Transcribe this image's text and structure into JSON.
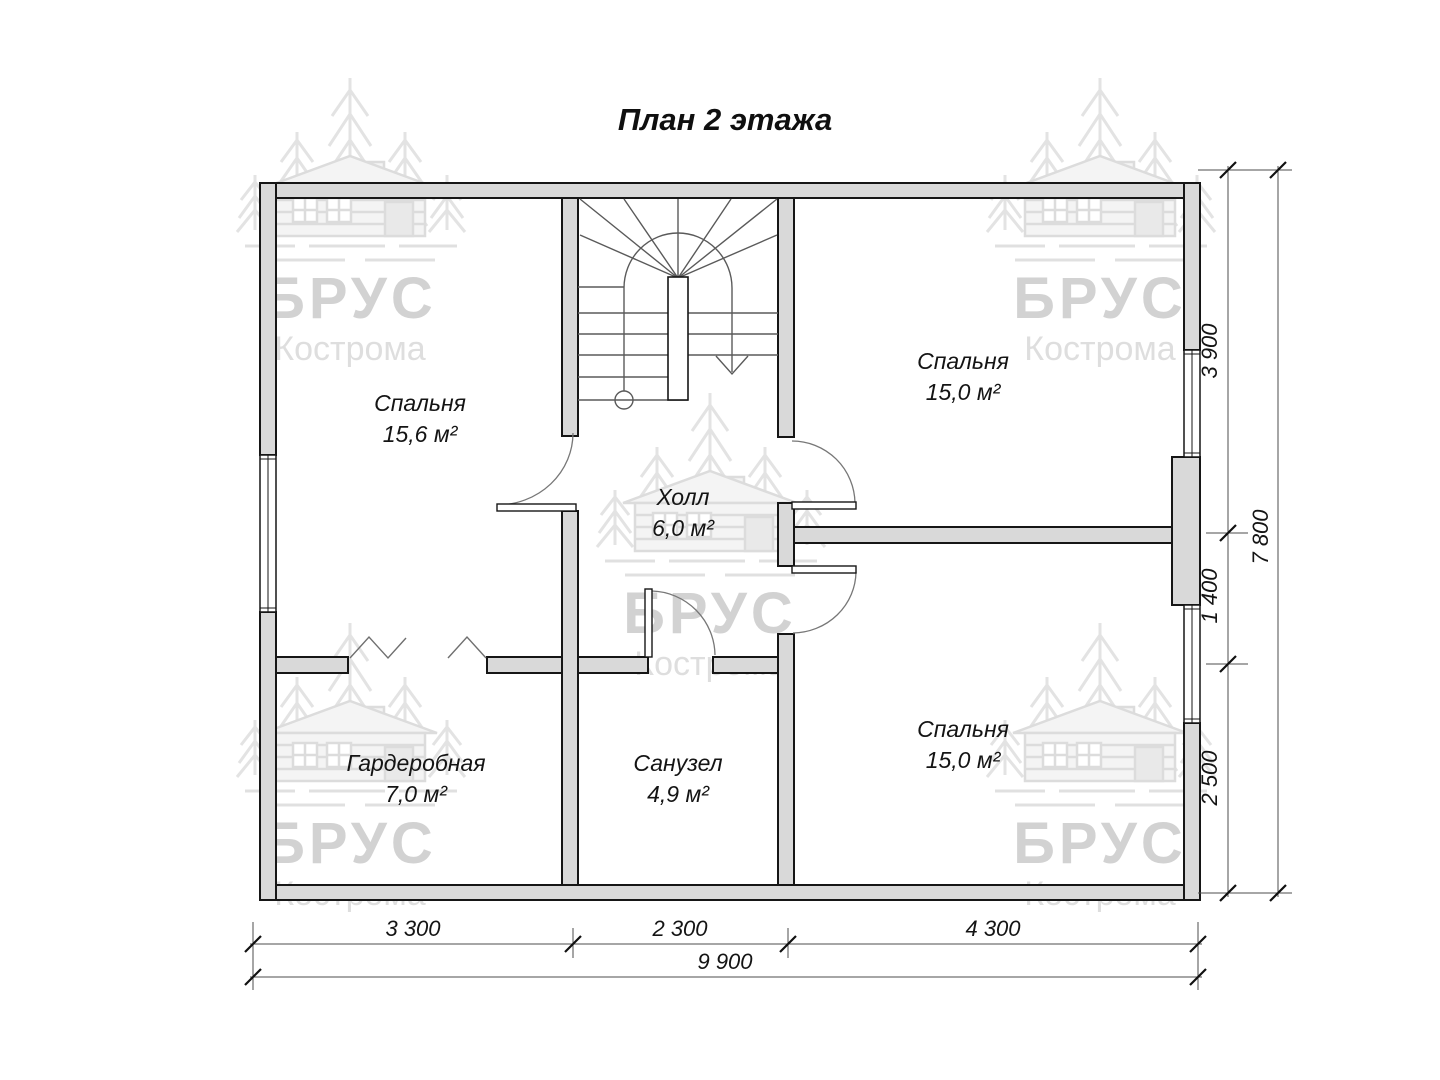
{
  "title": "План 2 этажа",
  "watermark": {
    "brand": "БРУС",
    "city": "Кострома"
  },
  "rooms": {
    "bedroom_left": {
      "name": "Спальня",
      "area": "15,6 м²"
    },
    "hall": {
      "name": "Холл",
      "area": "6,0 м²"
    },
    "bedroom_top_right": {
      "name": "Спальня",
      "area": "15,0 м²"
    },
    "wardrobe": {
      "name": "Гардеробная",
      "area": "7,0 м²"
    },
    "bathroom": {
      "name": "Санузел",
      "area": "4,9 м²"
    },
    "bedroom_bottom_right": {
      "name": "Спальня",
      "area": "15,0 м²"
    }
  },
  "dimensions": {
    "right_segments": [
      "3 900",
      "1 400",
      "2 500"
    ],
    "right_total": "7 800",
    "bottom_segments": [
      "3 300",
      "2 300",
      "4 300"
    ],
    "bottom_total": "9 900"
  },
  "colors": {
    "wall_fill": "#d9d9d9",
    "line": "#161616",
    "thin_line": "#5a5a5a",
    "watermark": "#dcdcdc"
  }
}
